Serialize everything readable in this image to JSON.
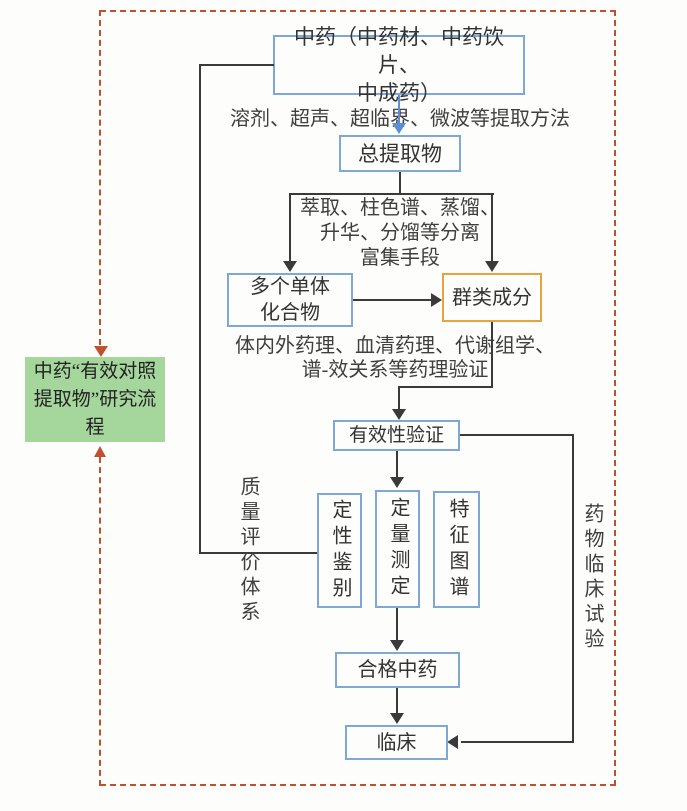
{
  "title_box": {
    "text": "中药“有效对照提取物”研究流程"
  },
  "nodes": {
    "herb_source": {
      "line1": "中药（中药材、中药饮片、",
      "line2": "中成药）"
    },
    "total_extract": {
      "label": "总提取物"
    },
    "monomers": {
      "line1": "多个单体",
      "line2": "化合物"
    },
    "component_group": {
      "label": "群类成分"
    },
    "efficacy_validation": {
      "label": "有效性验证"
    },
    "qualitative_id": {
      "label": "定性鉴别"
    },
    "quantitative_assay": {
      "label": "定量测定"
    },
    "characteristic_chromatogram": {
      "label": "特征图谱"
    },
    "qualified_tcm": {
      "label": "合格中药"
    },
    "clinic": {
      "label": "临床"
    }
  },
  "annotations": {
    "extraction_methods": "溶剂、超声、超临界、微波等提取方法",
    "separation": {
      "line1": "萃取、柱色谱、蒸馏、",
      "line2": "升华、分馏等分离",
      "line3": "富集手段"
    },
    "pharmacology": {
      "line1": "体内外药理、血清药理、代谢组学、",
      "line2": "谱-效关系等药理验证"
    },
    "quality_system": "质量评价体系",
    "clinical_trial": "药物临床试验"
  },
  "colors": {
    "blue_box_border": "#7fa8d9",
    "orange_box_border": "#e8a33c",
    "green_box_fill": "#a5d69c",
    "dashed_frame": "#c0512f",
    "connector_line": "#3a3a3a",
    "blue_arrow": "#5b8fd4"
  }
}
